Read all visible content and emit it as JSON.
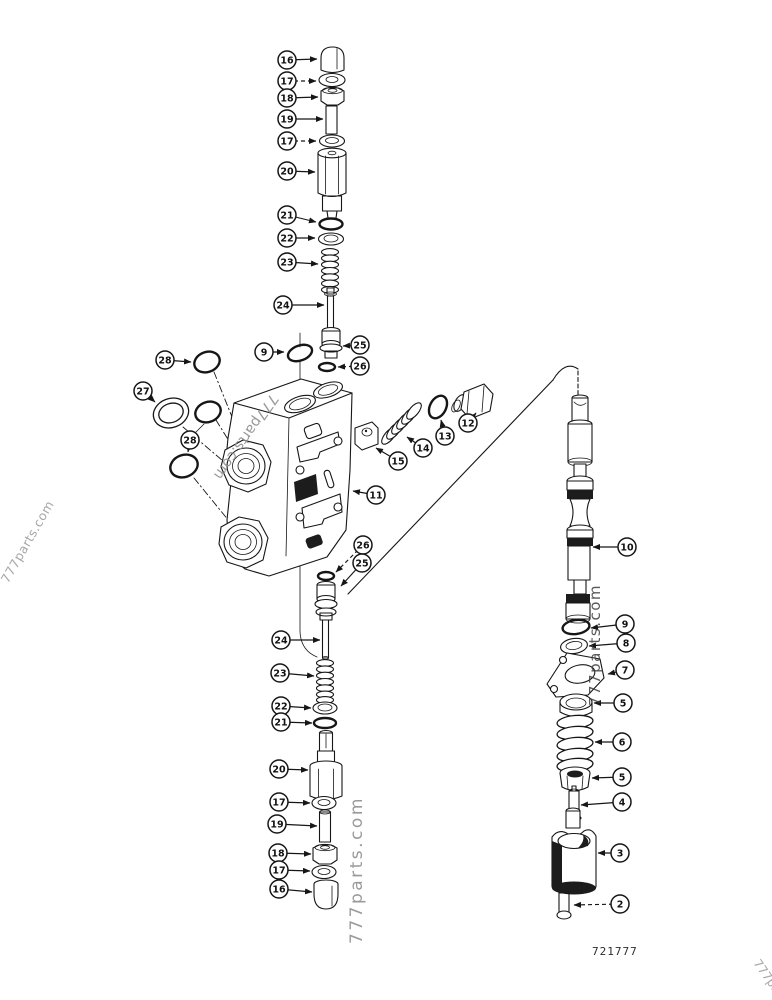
{
  "watermark": {
    "text": "777parts.com"
  },
  "figure_number": "721777",
  "callouts": [
    {
      "n": "16",
      "cx": 287,
      "cy": 60,
      "tx": 317,
      "ty": 59,
      "dashed": false
    },
    {
      "n": "17",
      "cx": 287,
      "cy": 81,
      "tx": 316,
      "ty": 81,
      "dashed": true
    },
    {
      "n": "18",
      "cx": 287,
      "cy": 98,
      "tx": 318,
      "ty": 97,
      "dashed": false
    },
    {
      "n": "19",
      "cx": 287,
      "cy": 119,
      "tx": 323,
      "ty": 119,
      "dashed": false
    },
    {
      "n": "17",
      "cx": 287,
      "cy": 141,
      "tx": 316,
      "ty": 141,
      "dashed": true
    },
    {
      "n": "20",
      "cx": 287,
      "cy": 171,
      "tx": 315,
      "ty": 172,
      "dashed": false
    },
    {
      "n": "21",
      "cx": 287,
      "cy": 215,
      "tx": 316,
      "ty": 222,
      "dashed": false
    },
    {
      "n": "22",
      "cx": 287,
      "cy": 238,
      "tx": 315,
      "ty": 238,
      "dashed": false
    },
    {
      "n": "23",
      "cx": 287,
      "cy": 262,
      "tx": 318,
      "ty": 264,
      "dashed": false
    },
    {
      "n": "24",
      "cx": 283,
      "cy": 305,
      "tx": 324,
      "ty": 305,
      "dashed": false
    },
    {
      "n": "9",
      "cx": 264,
      "cy": 352,
      "tx": 284,
      "ty": 352,
      "dashed": false
    },
    {
      "n": "25",
      "cx": 360,
      "cy": 345,
      "tx": 343,
      "ty": 346,
      "dashed": false
    },
    {
      "n": "26",
      "cx": 360,
      "cy": 366,
      "tx": 338,
      "ty": 367,
      "dashed": true
    },
    {
      "n": "28",
      "cx": 165,
      "cy": 360,
      "tx": 191,
      "ty": 362,
      "dashed": false
    },
    {
      "n": "27",
      "cx": 143,
      "cy": 391,
      "tx": 155,
      "ty": 402,
      "dashed": false
    },
    {
      "n": "28",
      "cx": 190,
      "cy": 440,
      "tx": 188,
      "ty": 452,
      "dashed": false
    },
    {
      "n": "11",
      "cx": 376,
      "cy": 495,
      "tx": 353,
      "ty": 491,
      "dashed": false
    },
    {
      "n": "15",
      "cx": 398,
      "cy": 461,
      "tx": 376,
      "ty": 448,
      "dashed": false
    },
    {
      "n": "14",
      "cx": 423,
      "cy": 448,
      "tx": 407,
      "ty": 437,
      "dashed": false
    },
    {
      "n": "13",
      "cx": 445,
      "cy": 436,
      "tx": 441,
      "ty": 420,
      "dashed": false
    },
    {
      "n": "12",
      "cx": 468,
      "cy": 423,
      "tx": 476,
      "ty": 413,
      "dashed": false
    },
    {
      "n": "26",
      "cx": 363,
      "cy": 545,
      "tx": 336,
      "ty": 572,
      "dashed": true
    },
    {
      "n": "25",
      "cx": 362,
      "cy": 563,
      "tx": 341,
      "ty": 586,
      "dashed": false
    },
    {
      "n": "24",
      "cx": 281,
      "cy": 640,
      "tx": 320,
      "ty": 640,
      "dashed": false
    },
    {
      "n": "23",
      "cx": 280,
      "cy": 673,
      "tx": 314,
      "ty": 676,
      "dashed": false
    },
    {
      "n": "22",
      "cx": 281,
      "cy": 706,
      "tx": 311,
      "ty": 708,
      "dashed": false
    },
    {
      "n": "21",
      "cx": 281,
      "cy": 722,
      "tx": 312,
      "ty": 723,
      "dashed": false
    },
    {
      "n": "20",
      "cx": 279,
      "cy": 769,
      "tx": 308,
      "ty": 770,
      "dashed": false
    },
    {
      "n": "17",
      "cx": 279,
      "cy": 802,
      "tx": 310,
      "ty": 803,
      "dashed": false
    },
    {
      "n": "19",
      "cx": 277,
      "cy": 824,
      "tx": 317,
      "ty": 826,
      "dashed": false
    },
    {
      "n": "18",
      "cx": 278,
      "cy": 853,
      "tx": 311,
      "ty": 854,
      "dashed": false
    },
    {
      "n": "17",
      "cx": 279,
      "cy": 870,
      "tx": 310,
      "ty": 871,
      "dashed": false
    },
    {
      "n": "16",
      "cx": 279,
      "cy": 889,
      "tx": 312,
      "ty": 892,
      "dashed": false
    },
    {
      "n": "10",
      "cx": 627,
      "cy": 547,
      "tx": 593,
      "ty": 547,
      "dashed": false
    },
    {
      "n": "9",
      "cx": 625,
      "cy": 624,
      "tx": 591,
      "ty": 628,
      "dashed": false
    },
    {
      "n": "8",
      "cx": 626,
      "cy": 643,
      "tx": 589,
      "ty": 646,
      "dashed": false
    },
    {
      "n": "7",
      "cx": 625,
      "cy": 670,
      "tx": 608,
      "ty": 674,
      "dashed": false
    },
    {
      "n": "5",
      "cx": 623,
      "cy": 703,
      "tx": 594,
      "ty": 703,
      "dashed": false
    },
    {
      "n": "6",
      "cx": 622,
      "cy": 742,
      "tx": 595,
      "ty": 742,
      "dashed": false
    },
    {
      "n": "5",
      "cx": 622,
      "cy": 777,
      "tx": 592,
      "ty": 778,
      "dashed": false
    },
    {
      "n": "4",
      "cx": 622,
      "cy": 802,
      "tx": 581,
      "ty": 805,
      "dashed": false
    },
    {
      "n": "3",
      "cx": 620,
      "cy": 853,
      "tx": 598,
      "ty": 853,
      "dashed": false
    },
    {
      "n": "2",
      "cx": 620,
      "cy": 904,
      "tx": 574,
      "ty": 905,
      "dashed": true
    }
  ]
}
